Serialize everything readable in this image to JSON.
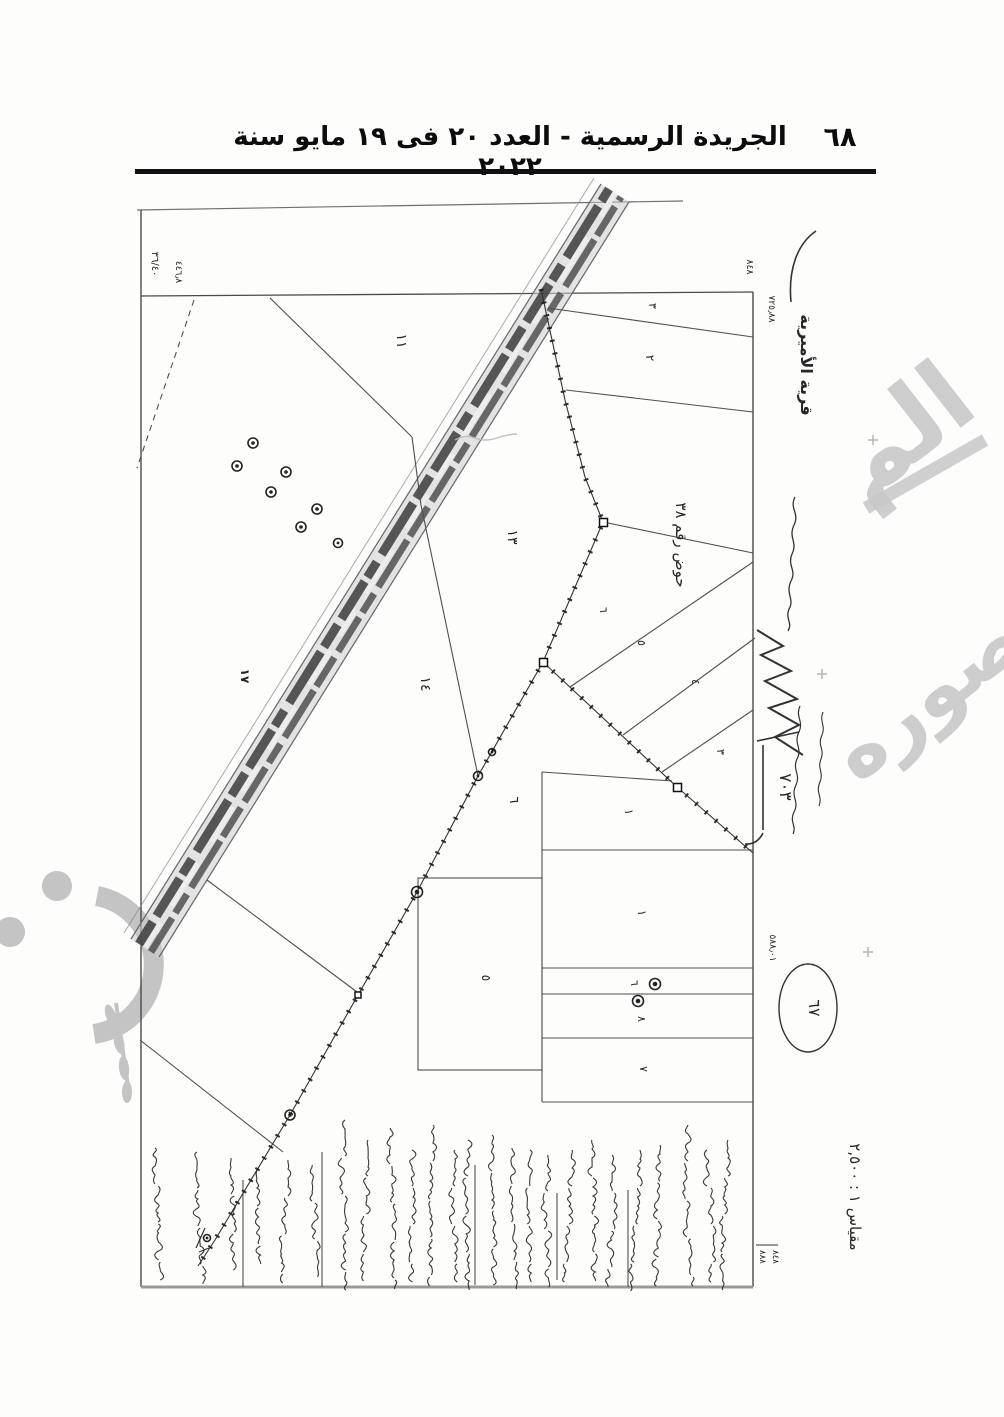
{
  "page": {
    "header": {
      "title": "الجريدة الرسمية - العدد ٢٠ فى ١٩ مايو سنة ٢٠٢٢",
      "page_number": "٦٨"
    }
  },
  "map": {
    "village_label": "قرية الأميرية",
    "basin_label": "حوض رقم ٣٨",
    "scale_label": "مقياس ١ : ٢,٥٠٠",
    "road_label": "١٧",
    "survey_note": "٧٠٣",
    "oval_number": "٦٧",
    "margin_numbers": {
      "top_left_fraction": "٣٦/٤٠",
      "top_left_value": "٤٤٦٫٨",
      "right_top": "٨٤٨",
      "right_upper": "٧٢٥٫٨٨",
      "right_lower": "٥٨٨٫٠١",
      "bottom_a": "٨٨٨",
      "bottom_b": "٨٤٨"
    },
    "parcel_numbers": {
      "p11": "١١",
      "p13": "١٣",
      "p14": "١٤",
      "p6": "٦",
      "p5": "٥",
      "t3": "٣",
      "t2": "٢",
      "s6": "٦",
      "s5": "٥",
      "s4": "٤",
      "s3": "٣",
      "b1": "١",
      "b2": "١",
      "b6": "٦",
      "b8": "٨",
      "b7": "٧"
    },
    "watermark": {
      "fragment_top": "الم",
      "fragment_bottom": "صوره",
      "color": "#c8c8c8"
    },
    "handwriting_description": "أسطر أسماء مكتوبة بخط اليد أسفل الخريطة وهوامشها (غير مقروءة)"
  }
}
